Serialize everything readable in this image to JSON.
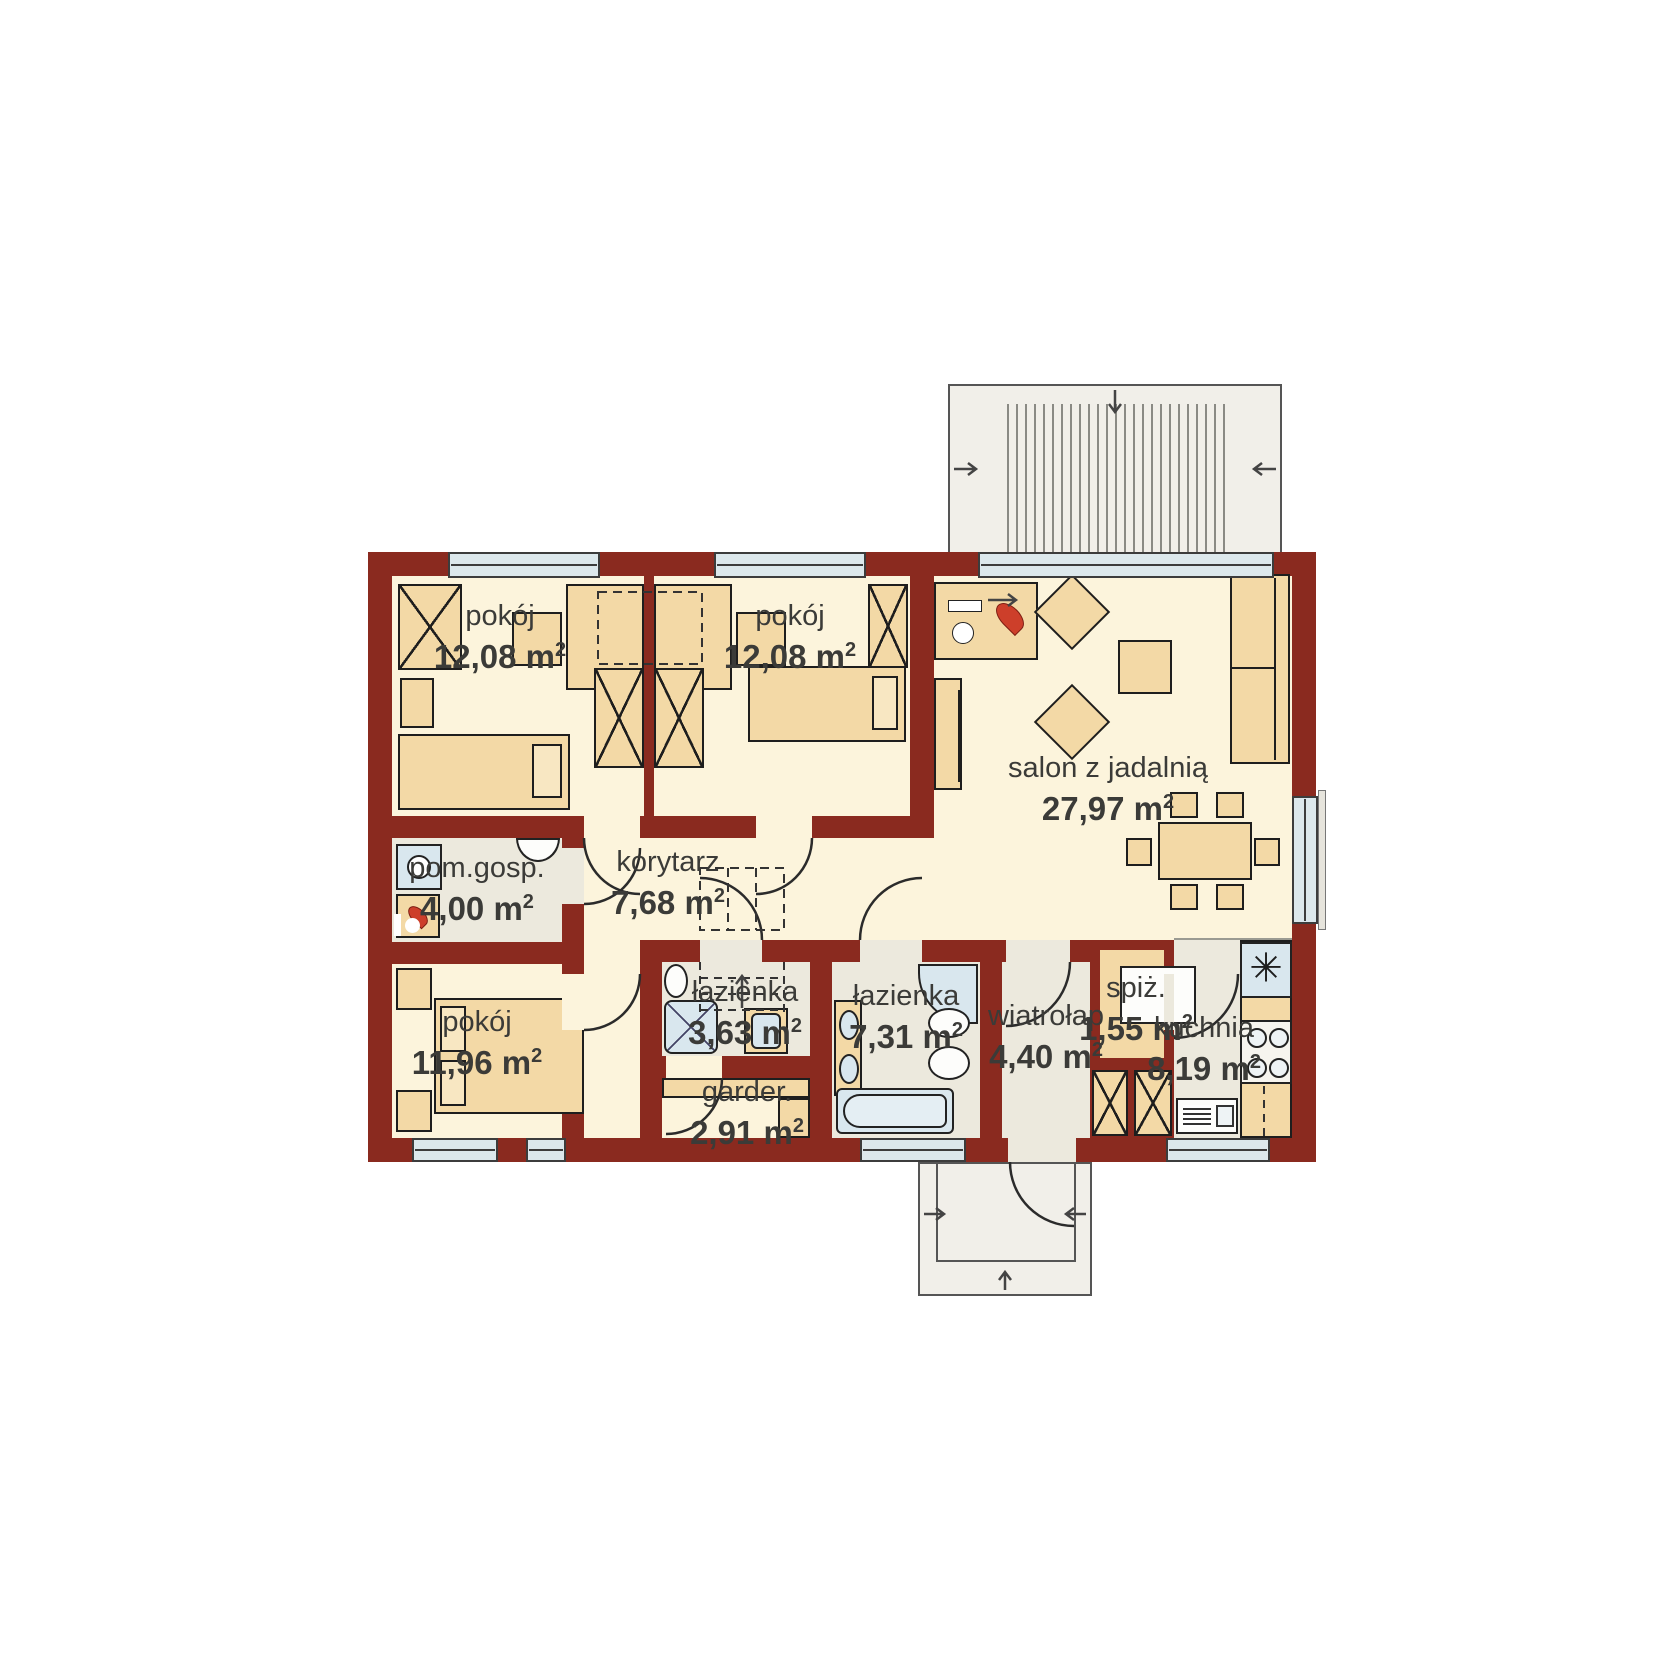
{
  "plan": {
    "rooms": [
      {
        "id": "pokoj-1",
        "name": "pokój",
        "area": "12,08",
        "unit": "m",
        "sup": "2"
      },
      {
        "id": "pokoj-2",
        "name": "pokój",
        "area": "12,08",
        "unit": "m",
        "sup": "2"
      },
      {
        "id": "salon",
        "name": "salon z jadalnią",
        "area": "27,97",
        "unit": "m",
        "sup": "2"
      },
      {
        "id": "pom-gosp",
        "name": "pom.gosp.",
        "area": "4,00",
        "unit": "m",
        "sup": "2"
      },
      {
        "id": "korytarz",
        "name": "korytarz",
        "area": "7,68",
        "unit": "m",
        "sup": "2"
      },
      {
        "id": "pokoj-3",
        "name": "pokój",
        "area": "11,96",
        "unit": "m",
        "sup": "2"
      },
      {
        "id": "lazienka-mala",
        "name": "łazienka",
        "area": "3,63",
        "unit": "m",
        "sup": "2"
      },
      {
        "id": "lazienka-duza",
        "name": "łazienka",
        "area": "7,31",
        "unit": "m",
        "sup": "2"
      },
      {
        "id": "garderoba",
        "name": "garder.",
        "area": "2,91",
        "unit": "m",
        "sup": "2"
      },
      {
        "id": "wiatrolap",
        "name": "wiatrołap",
        "area": "4,40",
        "unit": "m",
        "sup": "2"
      },
      {
        "id": "spizarnia",
        "name": "spiż.",
        "area": "1,55",
        "unit": "m",
        "sup": "2"
      },
      {
        "id": "kuchnia",
        "name": "kuchnia",
        "area": "8,19",
        "unit": "m",
        "sup": "2"
      }
    ],
    "icons": {
      "sink_star": "✳",
      "fireplace_flame": "flame",
      "boiler_flame": "flame",
      "entry_arrows": "direction-arrows"
    },
    "colors": {
      "wall": "#8a2a1f",
      "floor_main": "#fcf4dc",
      "floor_service": "#ece9dd",
      "furniture": "#f3d9a6",
      "fixture_blue": "#d9e7ee",
      "flame": "#cd3f2a",
      "terrace": "#f1efe9",
      "outline": "#1e1e1e"
    }
  }
}
